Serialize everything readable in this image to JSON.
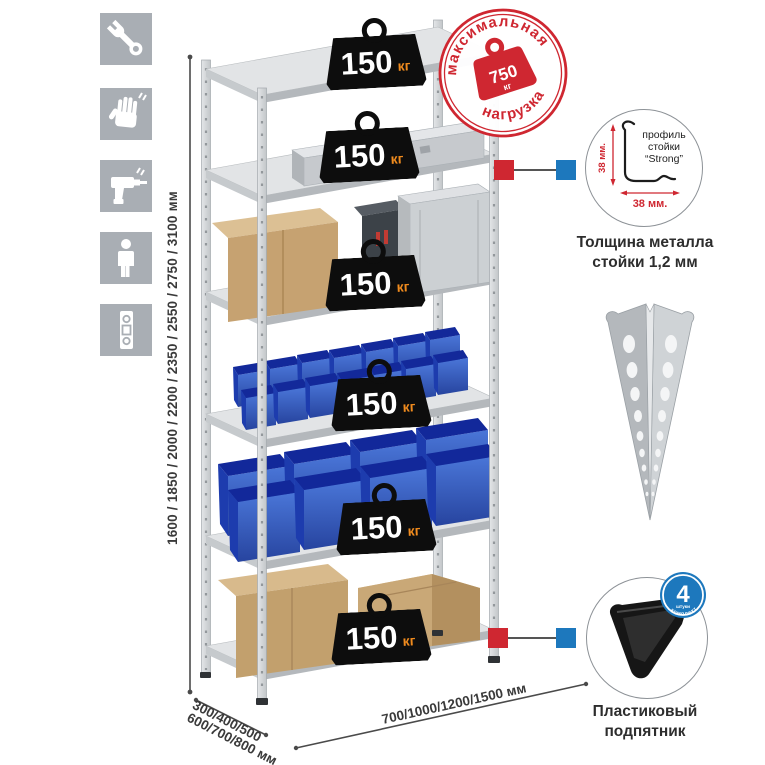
{
  "colors": {
    "accent_red": "#cf2731",
    "accent_blue": "#1d78bd",
    "bin_blue": "#2c55be",
    "weight_black": "#0d0d0d",
    "unit_orange": "#f08b1e",
    "icon_tile_gray": "#a9aeb4"
  },
  "feature_icons": [
    {
      "name": "wrench-icon"
    },
    {
      "name": "gloves-icon"
    },
    {
      "name": "drill-icon"
    },
    {
      "name": "person-icon"
    },
    {
      "name": "level-icon"
    }
  ],
  "dimensions": {
    "height": "1600 / 1850 / 2000 / 2200 / 2350 / 2550 / 2750 / 3100 мм",
    "depth_line1": "300/400/500",
    "depth_line2": "600/700/800 мм",
    "width": "700/1000/1200/1500 мм"
  },
  "shelf_badges": [
    {
      "value": "150",
      "unit": "кг"
    },
    {
      "value": "150",
      "unit": "кг"
    },
    {
      "value": "150",
      "unit": "кг"
    },
    {
      "value": "150",
      "unit": "кг"
    },
    {
      "value": "150",
      "unit": "кг"
    },
    {
      "value": "150",
      "unit": "кг"
    }
  ],
  "max_load_stamp": {
    "arc_top": "максимальная",
    "arc_bottom": "нагрузка",
    "value": "750",
    "unit": "кг"
  },
  "profile_detail": {
    "label_line1": "профиль",
    "label_line2": "стойки",
    "label_line3": "“Strong”",
    "dim_vertical": "38 мм.",
    "dim_horizontal": "38 мм.",
    "caption_line1": "Толщина металла",
    "caption_line2": "стойки 1,2 мм"
  },
  "foot_detail": {
    "badge_value": "4",
    "badge_small": "штуки",
    "badge_arc": "в комплекте",
    "caption_line1": "Пластиковый",
    "caption_line2": "подпятник"
  }
}
